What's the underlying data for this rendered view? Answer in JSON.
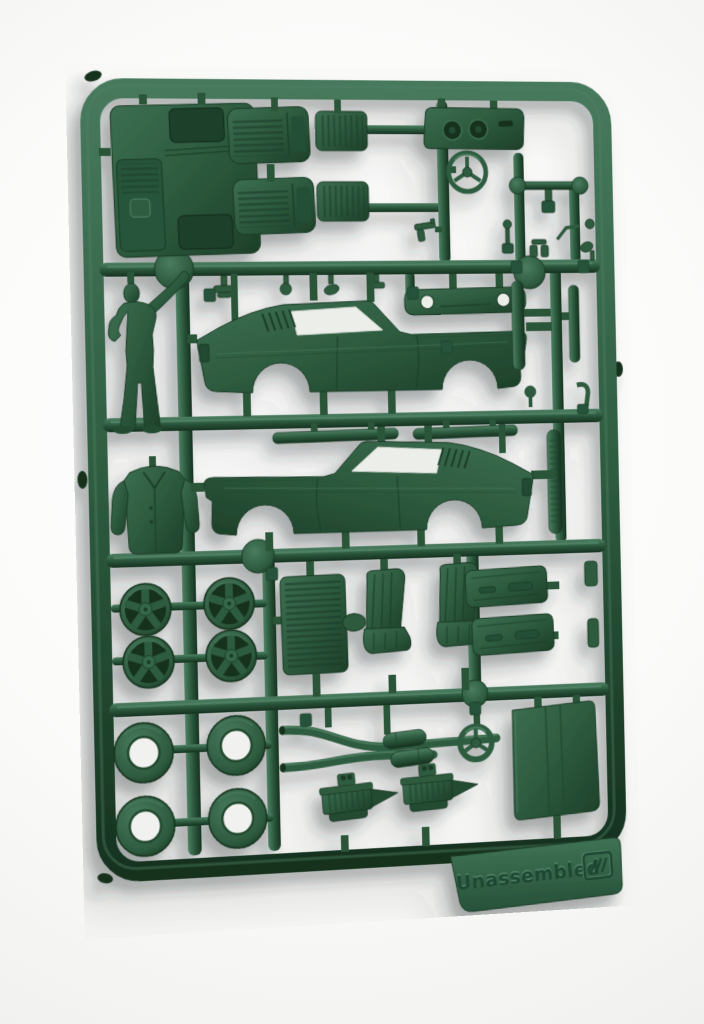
{
  "scene": {
    "subject": "plastic-model-kit-sprue-photo",
    "background_color": "#f4f4f2",
    "plastic_colors": {
      "highlight": "#4d7f63",
      "base": "#2d5a3e",
      "shadow": "#1b3b27",
      "deep": "#12291b"
    },
    "shadow_color": "#2c3833",
    "tag": {
      "label": "Unassembled",
      "logo": "three-stripes-badge"
    }
  },
  "parts": [
    {
      "id": "sprue-frame"
    },
    {
      "id": "floor-pan"
    },
    {
      "id": "interior-trim-panels"
    },
    {
      "id": "chassis-frame-part"
    },
    {
      "id": "dashboard"
    },
    {
      "id": "steering-wheel"
    },
    {
      "id": "small-detail-parts"
    },
    {
      "id": "driver-figure"
    },
    {
      "id": "jacket-part"
    },
    {
      "id": "body-side-upper"
    },
    {
      "id": "body-side-lower"
    },
    {
      "id": "front-valance"
    },
    {
      "id": "bumper-strips"
    },
    {
      "id": "rocker-sill-strips"
    },
    {
      "id": "five-spoke-wheels"
    },
    {
      "id": "tires"
    },
    {
      "id": "radiator-grille"
    },
    {
      "id": "bucket-seats"
    },
    {
      "id": "door-panels"
    },
    {
      "id": "exhaust-y-pipe"
    },
    {
      "id": "mufflers"
    },
    {
      "id": "engine-blocks"
    },
    {
      "id": "pulley-wheel"
    },
    {
      "id": "hood-panel"
    },
    {
      "id": "unassembled-tag"
    }
  ]
}
